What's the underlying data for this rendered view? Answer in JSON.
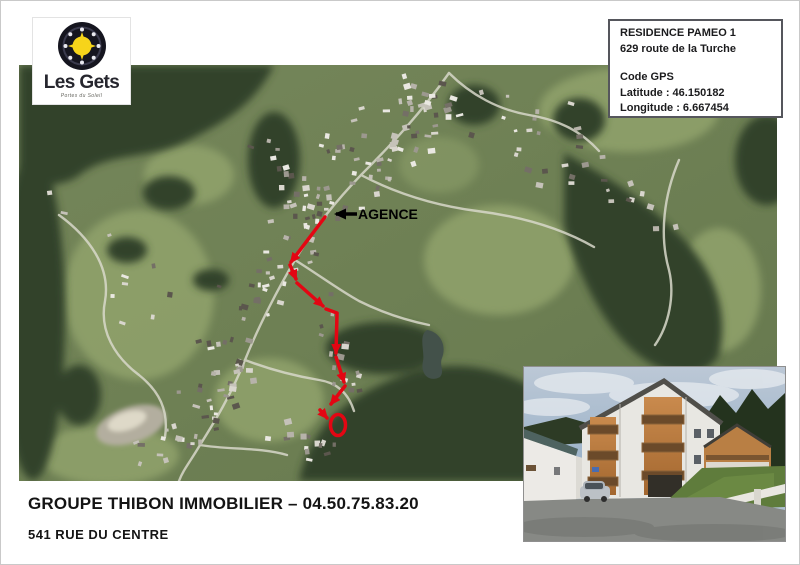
{
  "logo": {
    "name": "Les Gets",
    "tagline": "Portes du Soleil"
  },
  "info_box": {
    "residence": "RESIDENCE PAMEO 1",
    "address": "629 route de la Turche",
    "gps_heading": "Code GPS",
    "latitude": "Latitude : 46.150182",
    "longitude": "Longitude : 6.667454"
  },
  "map": {
    "agence_label": "AGENCE"
  },
  "footer": {
    "agency": "GROUPE THIBON IMMOBILIER – 04.50.75.83.20",
    "address": "541 RUE DU CENTRE"
  },
  "colors": {
    "route": "#e30613",
    "agence_arrow": "#000000"
  }
}
